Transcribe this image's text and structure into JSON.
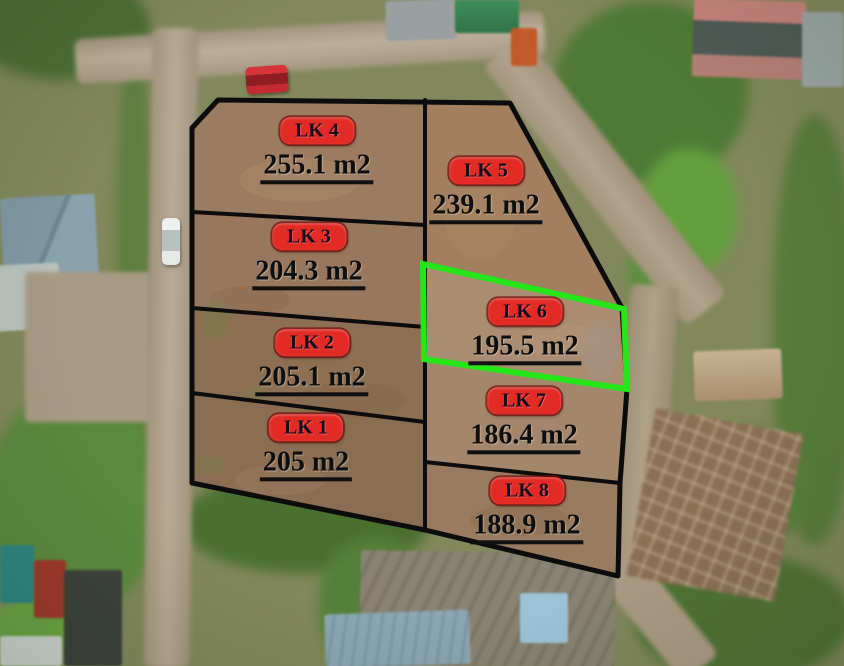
{
  "map": {
    "plots": [
      {
        "label": "LK 1",
        "area": "205 m2",
        "highlighted": false
      },
      {
        "label": "LK 2",
        "area": "205.1 m2",
        "highlighted": false
      },
      {
        "label": "LK 3",
        "area": "204.3 m2",
        "highlighted": false
      },
      {
        "label": "LK 4",
        "area": "255.1 m2",
        "highlighted": false
      },
      {
        "label": "LK 5",
        "area": "239.1 m2",
        "highlighted": false
      },
      {
        "label": "LK 6",
        "area": "195.5 m2",
        "highlighted": true
      },
      {
        "label": "LK 7",
        "area": "186.4 m2",
        "highlighted": false
      },
      {
        "label": "LK 8",
        "area": "188.9 m2",
        "highlighted": false
      }
    ],
    "colors": {
      "badge_red": "#e32b25",
      "highlight_green": "#24e618",
      "boundary_black": "#0c0c0c",
      "area_ink": "#0e0e0e"
    }
  }
}
